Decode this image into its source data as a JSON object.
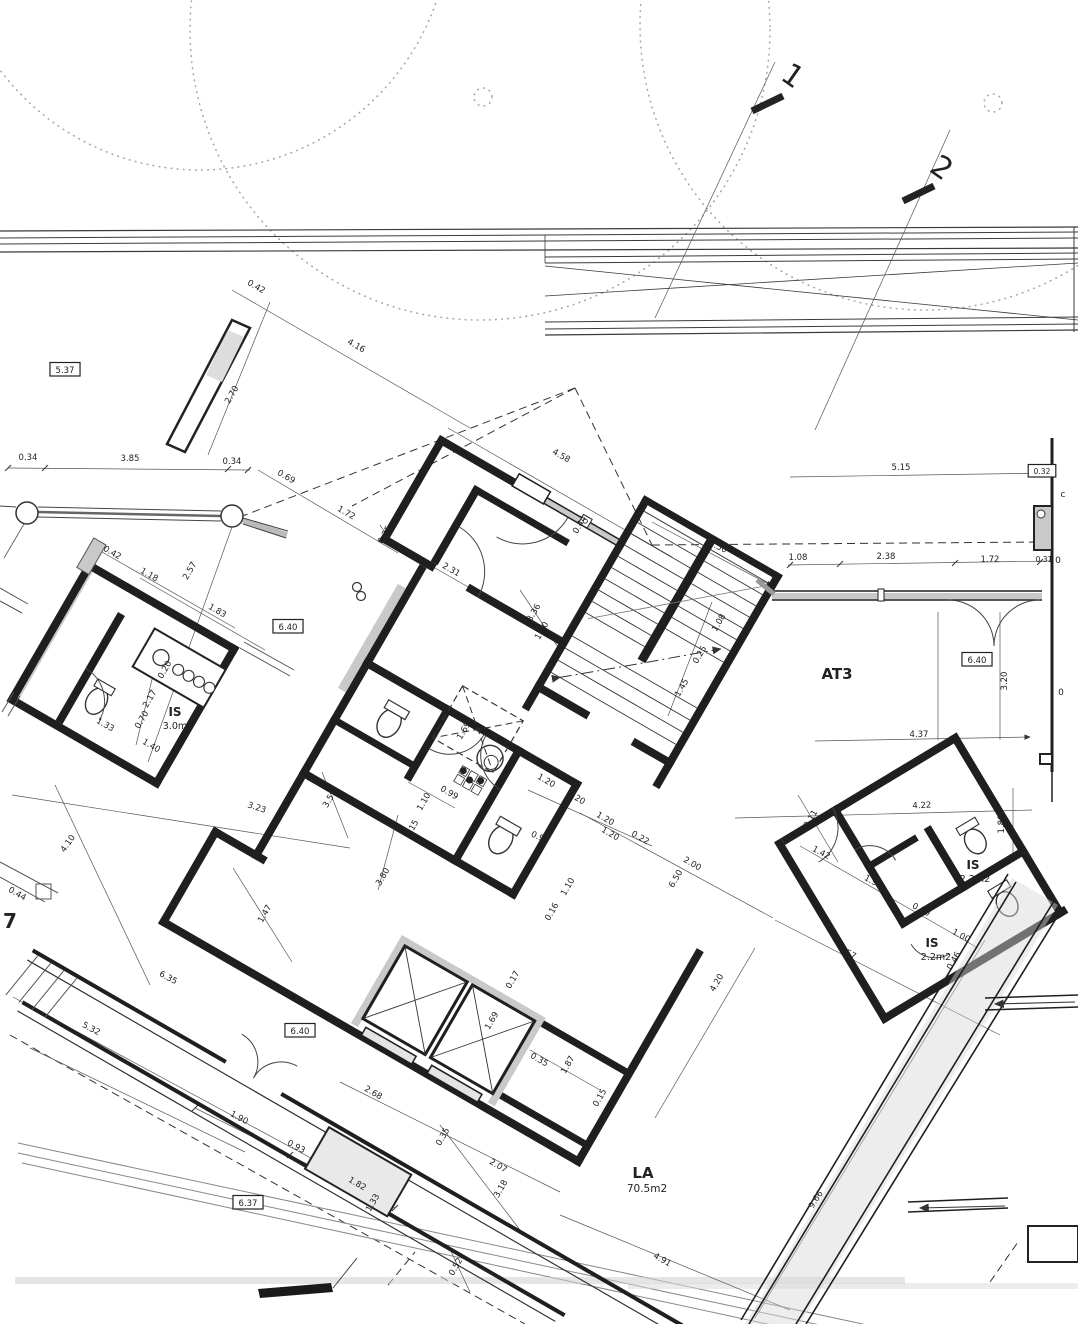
{
  "drawing": {
    "type": "architectural floor plan (site level, rotated building)",
    "colors": {
      "wall": "#1f1f1f",
      "thin_line": "#555555",
      "poche_gray": "#c9c9c9",
      "dashed": "#333333"
    },
    "rooms": [
      {
        "name": "AT3",
        "area": ""
      },
      {
        "name": "IS",
        "area": "3.0m2"
      },
      {
        "name": "IS",
        "area": "2.2m2"
      },
      {
        "name": "IS",
        "area": "2.2m2"
      },
      {
        "name": "LA",
        "area": "70.5m2"
      }
    ],
    "level_boxes": [
      "5.37",
      "6.40",
      "6.40",
      "6.40",
      "6.37"
    ],
    "section_markers": [
      "1",
      "2"
    ]
  },
  "labels": [
    {
      "t": "1",
      "x": 787,
      "y": 84,
      "r": 35,
      "s": 30,
      "k": "mark"
    },
    {
      "t": "2",
      "x": 936,
      "y": 176,
      "r": 35,
      "s": 30,
      "k": "mark"
    },
    {
      "t": "5.37",
      "x": 65,
      "y": 373,
      "r": 0,
      "k": "box"
    },
    {
      "t": "6.40",
      "x": 288,
      "y": 630,
      "r": 0,
      "k": "box"
    },
    {
      "t": "6.40",
      "x": 977,
      "y": 663,
      "r": 0,
      "k": "box"
    },
    {
      "t": "6.40",
      "x": 300,
      "y": 1034,
      "r": 0,
      "k": "box"
    },
    {
      "t": "6.37",
      "x": 248,
      "y": 1206,
      "r": 0,
      "k": "box"
    },
    {
      "t": "0.32",
      "x": 1042,
      "y": 474,
      "r": 0,
      "s": 7.5,
      "k": "box"
    },
    {
      "t": "AT3",
      "x": 837,
      "y": 679,
      "r": 0,
      "s": 15,
      "b": 1,
      "k": "room"
    },
    {
      "t": "IS",
      "x": 175,
      "y": 716,
      "r": 0,
      "s": 12,
      "b": 1,
      "k": "room"
    },
    {
      "t": "3.0m2",
      "x": 178,
      "y": 729,
      "r": 0,
      "s": 9.5,
      "k": "area"
    },
    {
      "t": "IS",
      "x": 973,
      "y": 869,
      "r": 0,
      "s": 12,
      "b": 1,
      "k": "room"
    },
    {
      "t": "2.2m2",
      "x": 975,
      "y": 882,
      "r": 0,
      "s": 9.5,
      "k": "area"
    },
    {
      "t": "IS",
      "x": 932,
      "y": 947,
      "r": 0,
      "s": 12,
      "b": 1,
      "k": "room"
    },
    {
      "t": "2.2m2",
      "x": 936,
      "y": 960,
      "r": 0,
      "s": 9.5,
      "k": "area"
    },
    {
      "t": "LA",
      "x": 643,
      "y": 1178,
      "r": 0,
      "s": 15,
      "b": 1,
      "k": "room"
    },
    {
      "t": "70.5m2",
      "x": 647,
      "y": 1192,
      "r": 0,
      "s": 10.5,
      "k": "area"
    },
    {
      "t": "0.42",
      "x": 255,
      "y": 289,
      "r": 30,
      "k": "dim"
    },
    {
      "t": "4.16",
      "x": 355,
      "y": 348,
      "r": 30,
      "k": "dim"
    },
    {
      "t": "2.70",
      "x": 234,
      "y": 396,
      "r": -60,
      "k": "dim"
    },
    {
      "t": "0.34",
      "x": 28,
      "y": 460,
      "r": 0,
      "k": "dim"
    },
    {
      "t": "3.85",
      "x": 130,
      "y": 461,
      "r": 0,
      "k": "dim"
    },
    {
      "t": "0.34",
      "x": 232,
      "y": 464,
      "r": 0,
      "k": "dim"
    },
    {
      "t": "0.69",
      "x": 285,
      "y": 479,
      "r": 30,
      "k": "dim"
    },
    {
      "t": "1.72",
      "x": 345,
      "y": 515,
      "r": 30,
      "k": "dim"
    },
    {
      "t": "4.58",
      "x": 560,
      "y": 458,
      "r": 30,
      "k": "dim"
    },
    {
      "t": "5.15",
      "x": 901,
      "y": 470,
      "r": 0,
      "k": "dim"
    },
    {
      "t": "2.50",
      "x": 717,
      "y": 549,
      "r": 25,
      "k": "dim"
    },
    {
      "t": "1.08",
      "x": 798,
      "y": 560,
      "r": 0,
      "k": "dim"
    },
    {
      "t": "2.38",
      "x": 886,
      "y": 559,
      "r": 0,
      "k": "dim"
    },
    {
      "t": "1.72",
      "x": 990,
      "y": 562,
      "r": 0,
      "k": "dim"
    },
    {
      "t": "0.31",
      "x": 1044,
      "y": 562,
      "r": 0,
      "s": 7.5,
      "k": "dim"
    },
    {
      "t": "0.35",
      "x": 387,
      "y": 536,
      "r": -60,
      "k": "dim"
    },
    {
      "t": "2.31",
      "x": 450,
      "y": 572,
      "r": 30,
      "k": "dim"
    },
    {
      "t": "0.44",
      "x": 582,
      "y": 526,
      "r": -60,
      "k": "dim"
    },
    {
      "t": "0.42",
      "x": 111,
      "y": 555,
      "r": 30,
      "k": "dim"
    },
    {
      "t": "1.18",
      "x": 148,
      "y": 577,
      "r": 30,
      "k": "dim"
    },
    {
      "t": "2.57",
      "x": 192,
      "y": 572,
      "r": -60,
      "k": "dim"
    },
    {
      "t": "1.83",
      "x": 216,
      "y": 613,
      "r": 30,
      "k": "dim"
    },
    {
      "t": "3.36",
      "x": 536,
      "y": 614,
      "r": -60,
      "k": "dim"
    },
    {
      "t": "1.40",
      "x": 544,
      "y": 632,
      "r": -60,
      "k": "dim"
    },
    {
      "t": "1.08",
      "x": 721,
      "y": 624,
      "r": -60,
      "k": "dim"
    },
    {
      "t": "0.25",
      "x": 702,
      "y": 656,
      "r": -60,
      "k": "dim"
    },
    {
      "t": "1.45",
      "x": 684,
      "y": 689,
      "r": -60,
      "k": "dim"
    },
    {
      "t": "3.20",
      "x": 1007,
      "y": 681,
      "r": -90,
      "k": "dim"
    },
    {
      "t": "4.37",
      "x": 919,
      "y": 737,
      "r": 0,
      "k": "dim"
    },
    {
      "t": "2.17",
      "x": 152,
      "y": 700,
      "r": -60,
      "k": "dim"
    },
    {
      "t": "0.70",
      "x": 144,
      "y": 721,
      "r": -60,
      "k": "dim"
    },
    {
      "t": "0.20",
      "x": 167,
      "y": 671,
      "r": -60,
      "k": "dim"
    },
    {
      "t": "1.40",
      "x": 150,
      "y": 748,
      "r": 30,
      "k": "dim"
    },
    {
      "t": "1.33",
      "x": 104,
      "y": 727,
      "r": 30,
      "k": "dim"
    },
    {
      "t": "3.23",
      "x": 256,
      "y": 810,
      "r": 18,
      "k": "dim"
    },
    {
      "t": "3.55",
      "x": 332,
      "y": 800,
      "r": -60,
      "k": "dim"
    },
    {
      "t": "4.10",
      "x": 70,
      "y": 845,
      "r": -55,
      "k": "dim"
    },
    {
      "t": "1.47",
      "x": 267,
      "y": 915,
      "r": -60,
      "k": "dim"
    },
    {
      "t": "0.44",
      "x": 16,
      "y": 896,
      "r": 30,
      "k": "dim"
    },
    {
      "t": "7",
      "x": 10,
      "y": 928,
      "r": 0,
      "s": 20,
      "b": 1,
      "k": "edge"
    },
    {
      "t": "0.99",
      "x": 448,
      "y": 795,
      "r": 30,
      "k": "dim"
    },
    {
      "t": "1.10",
      "x": 426,
      "y": 803,
      "r": -60,
      "k": "dim"
    },
    {
      "t": "0.15",
      "x": 414,
      "y": 830,
      "r": -60,
      "k": "dim"
    },
    {
      "t": "3.80",
      "x": 385,
      "y": 878,
      "r": -60,
      "k": "dim"
    },
    {
      "t": "1.20",
      "x": 545,
      "y": 783,
      "r": 30,
      "k": "dim"
    },
    {
      "t": "0.20",
      "x": 575,
      "y": 800,
      "r": 30,
      "k": "dim"
    },
    {
      "t": "1.20",
      "x": 604,
      "y": 821,
      "r": 30,
      "k": "dim"
    },
    {
      "t": "1.20",
      "x": 609,
      "y": 836,
      "r": 30,
      "k": "dim"
    },
    {
      "t": "0.92",
      "x": 539,
      "y": 840,
      "r": 25,
      "k": "dim"
    },
    {
      "t": "0.22",
      "x": 639,
      "y": 840,
      "r": 30,
      "k": "dim"
    },
    {
      "t": "2.00",
      "x": 691,
      "y": 866,
      "r": 30,
      "k": "dim"
    },
    {
      "t": "6.50",
      "x": 678,
      "y": 880,
      "r": -60,
      "k": "dim"
    },
    {
      "t": "1.10",
      "x": 570,
      "y": 888,
      "r": -60,
      "k": "dim"
    },
    {
      "t": "0.16",
      "x": 554,
      "y": 913,
      "r": -60,
      "k": "dim"
    },
    {
      "t": "0.17",
      "x": 515,
      "y": 981,
      "r": -60,
      "k": "dim"
    },
    {
      "t": "1.69",
      "x": 466,
      "y": 732,
      "r": -60,
      "k": "dim"
    },
    {
      "t": "1.69",
      "x": 494,
      "y": 1022,
      "r": -60,
      "k": "dim"
    },
    {
      "t": "4.20",
      "x": 719,
      "y": 984,
      "r": -60,
      "k": "dim"
    },
    {
      "t": "0.35",
      "x": 538,
      "y": 1062,
      "r": 30,
      "k": "dim"
    },
    {
      "t": "1.87",
      "x": 570,
      "y": 1066,
      "r": -60,
      "k": "dim"
    },
    {
      "t": "0.15",
      "x": 602,
      "y": 1099,
      "r": -60,
      "k": "dim"
    },
    {
      "t": "2.68",
      "x": 372,
      "y": 1095,
      "r": 30,
      "k": "dim"
    },
    {
      "t": "0.35",
      "x": 445,
      "y": 1138,
      "r": -60,
      "k": "dim"
    },
    {
      "t": "2.07",
      "x": 497,
      "y": 1168,
      "r": 30,
      "k": "dim"
    },
    {
      "t": "3.18",
      "x": 503,
      "y": 1190,
      "r": -60,
      "k": "dim"
    },
    {
      "t": "0.52",
      "x": 458,
      "y": 1268,
      "r": -60,
      "k": "dim"
    },
    {
      "t": "1.82",
      "x": 356,
      "y": 1186,
      "r": 30,
      "k": "dim"
    },
    {
      "t": "1.33",
      "x": 375,
      "y": 1204,
      "r": -60,
      "k": "dim"
    },
    {
      "t": "4.91",
      "x": 661,
      "y": 1262,
      "r": 30,
      "k": "dim"
    },
    {
      "t": "6.35",
      "x": 167,
      "y": 980,
      "r": 28,
      "k": "dim"
    },
    {
      "t": "5.32",
      "x": 90,
      "y": 1031,
      "r": 28,
      "k": "dim"
    },
    {
      "t": "1.90",
      "x": 238,
      "y": 1120,
      "r": 28,
      "k": "dim"
    },
    {
      "t": "0.93",
      "x": 295,
      "y": 1149,
      "r": 28,
      "k": "dim"
    },
    {
      "t": "4.22",
      "x": 922,
      "y": 808,
      "r": -3,
      "k": "dim"
    },
    {
      "t": "3.11",
      "x": 813,
      "y": 820,
      "r": -60,
      "k": "dim"
    },
    {
      "t": "1.42",
      "x": 820,
      "y": 855,
      "r": 28,
      "k": "dim"
    },
    {
      "t": "1.90",
      "x": 872,
      "y": 884,
      "r": 28,
      "k": "dim"
    },
    {
      "t": "0.80",
      "x": 920,
      "y": 912,
      "r": 28,
      "k": "dim"
    },
    {
      "t": "1.00",
      "x": 960,
      "y": 938,
      "r": 28,
      "k": "dim"
    },
    {
      "t": "1.80",
      "x": 1004,
      "y": 824,
      "r": -90,
      "k": "dim"
    },
    {
      "t": "4.57",
      "x": 846,
      "y": 955,
      "r": 27,
      "k": "dim"
    },
    {
      "t": "0.46",
      "x": 956,
      "y": 962,
      "r": -60,
      "k": "dim"
    },
    {
      "t": "9.66",
      "x": 818,
      "y": 1201,
      "r": -57,
      "k": "dim"
    },
    {
      "t": "c",
      "x": 1063,
      "y": 497,
      "r": 0,
      "s": 9,
      "k": "edge"
    },
    {
      "t": "0",
      "x": 1058,
      "y": 563,
      "r": 0,
      "s": 9,
      "k": "edge"
    },
    {
      "t": "0",
      "x": 1061,
      "y": 695,
      "r": 0,
      "s": 9,
      "k": "edge"
    }
  ]
}
